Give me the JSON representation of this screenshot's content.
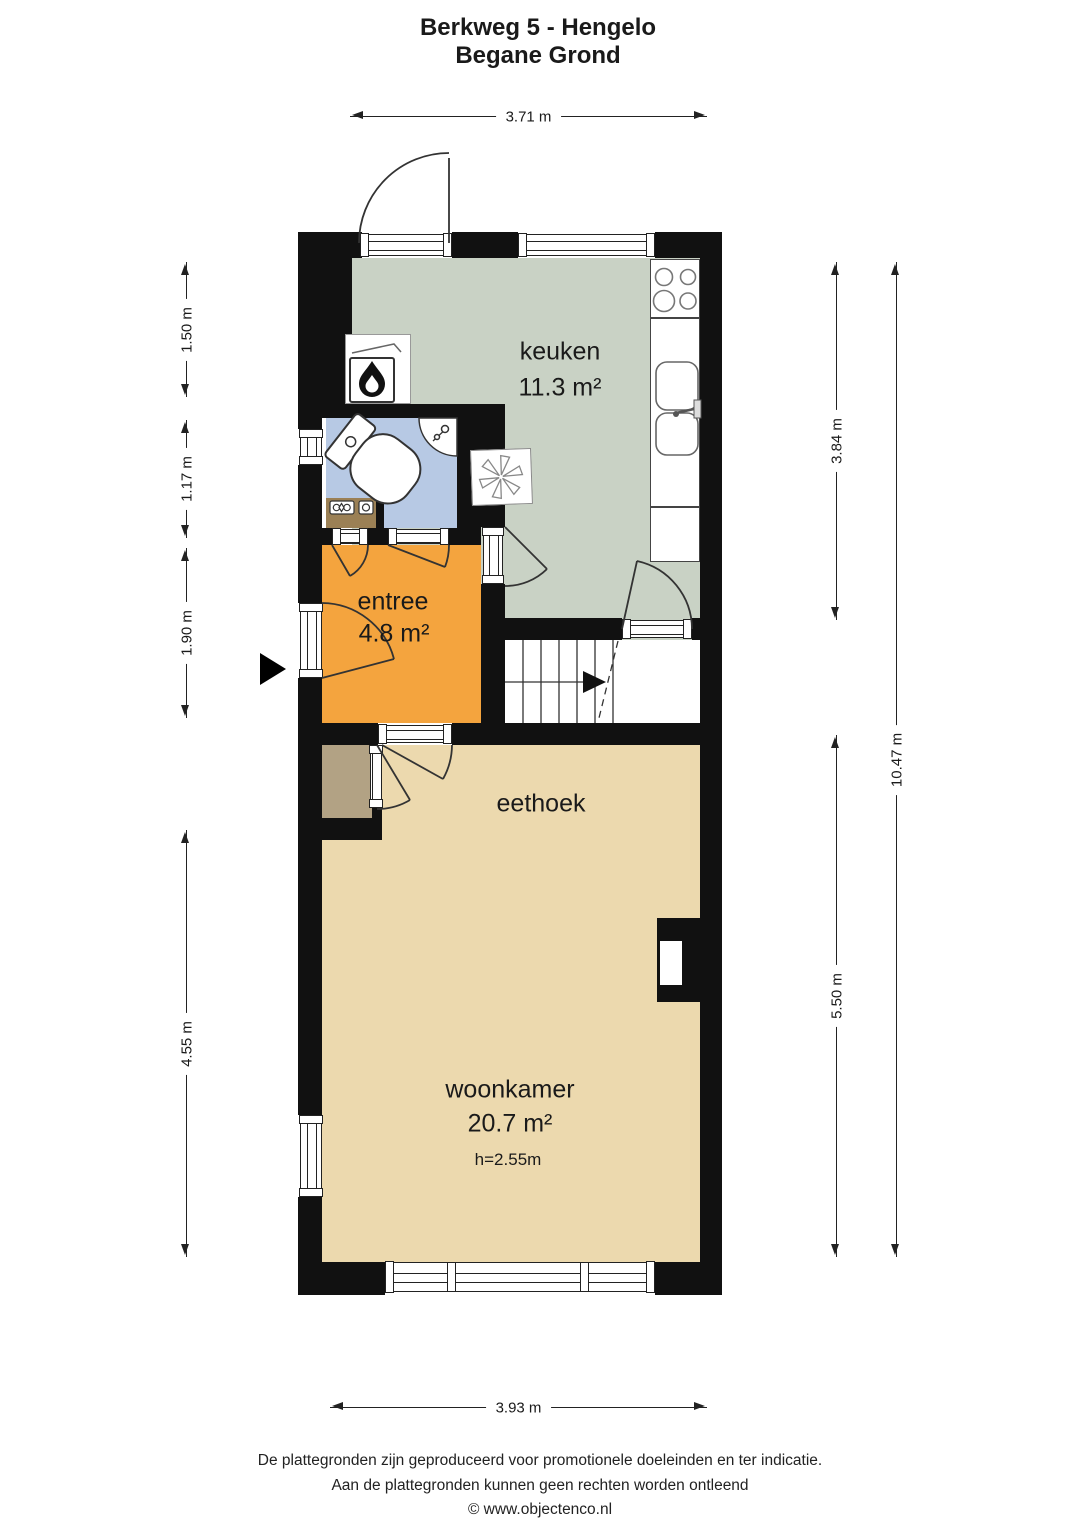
{
  "title": {
    "line1": "Berkweg 5 - Hengelo",
    "line2": "Begane Grond"
  },
  "rooms": {
    "keuken": {
      "label": "keuken",
      "area": "11.3 m²"
    },
    "entree": {
      "label": "entree",
      "area": "4.8 m²"
    },
    "eethoek": {
      "label": "eethoek"
    },
    "woonkamer": {
      "label": "woonkamer",
      "area": "20.7 m²",
      "ceiling_height": "h=2.55m"
    }
  },
  "dimensions": {
    "top_width": "3.71 m",
    "bottom_width": "3.93 m",
    "left": {
      "d1": "1.50 m",
      "d2": "1.17 m",
      "d3": "1.90 m",
      "d4": "4.55 m"
    },
    "right": {
      "kitchen": "3.84 m",
      "living": "5.50 m",
      "total": "10.47 m"
    }
  },
  "footer": {
    "line1": "De plattegronden zijn geproduceerd voor promotionele doeleinden en ter indicatie.",
    "line2": "Aan de plattegronden kunnen geen rechten worden ontleend",
    "line3": "© www.objectenco.nl"
  },
  "colors": {
    "wall": "#111111",
    "kitchen_floor": "#c9d2c5",
    "bathroom_floor": "#b7c9e4",
    "entree_floor": "#f4a43e",
    "living_floor": "#ecd9ae",
    "meter_closet": "#9b8055",
    "storage_closet": "#b2a284"
  },
  "icons": {
    "boiler": "flame-icon",
    "ventilation": "fan-icon",
    "entrance": "entrance-arrow-icon",
    "stairs": "stairs-direction-arrow-icon"
  }
}
